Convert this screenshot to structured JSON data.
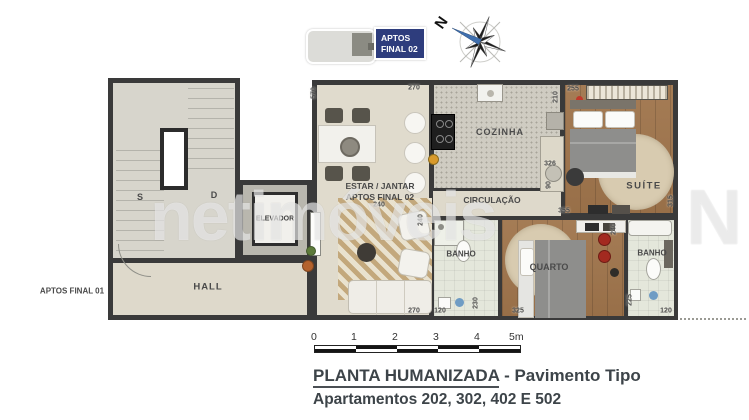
{
  "legend": {
    "aptos_line1": "APTOS",
    "aptos_line2": "FINAL 02",
    "north": "N"
  },
  "watermark": {
    "text": "netimóveis",
    "logo": "N"
  },
  "plan": {
    "stairs_up": "S",
    "stairs_down": "D",
    "elevator": "ELEVADOR",
    "hall": "HALL",
    "aptos_final_01": "APTOS FINAL 01",
    "estar_line1": "ESTAR / JANTAR",
    "estar_line2": "APTOS FINAL 02",
    "cozinha": "COZINHA",
    "circulacao": "CIRCULAÇÃO",
    "suite": "SUÍTE",
    "banho_left": "BANHO",
    "quarto": "QUARTO",
    "banho_right": "BANHO"
  },
  "dimensions": {
    "estar_left": "570",
    "estar_top": "270",
    "suite_closet": "255",
    "cozinha_right": "210",
    "cozinha_bottom": "326",
    "circ_small": "90",
    "corridor_top": "240",
    "corridor_left": "240",
    "quarto_top": "355",
    "suite_right": "315",
    "quarto_right": "240",
    "quarto_left": "230",
    "estar_bottom": "270",
    "banho_left_bottom": "120",
    "quarto_bottom": "325",
    "banho_right_left": "225",
    "banho_right_bottom": "120"
  },
  "scalebar": {
    "ticks": [
      "0",
      "1",
      "2",
      "3",
      "4",
      "5m"
    ]
  },
  "title": {
    "heading": "PLANTA HUMANIZADA",
    "heading_suffix": " - Pavimento Tipo",
    "subtitle": "Apartamentos 202, 302, 402 E 502"
  },
  "colors": {
    "accent_blue": "#2e3d7d",
    "wall": "#3a3a3a",
    "wood": "#a0754c",
    "red_decor": "#a32a20"
  }
}
